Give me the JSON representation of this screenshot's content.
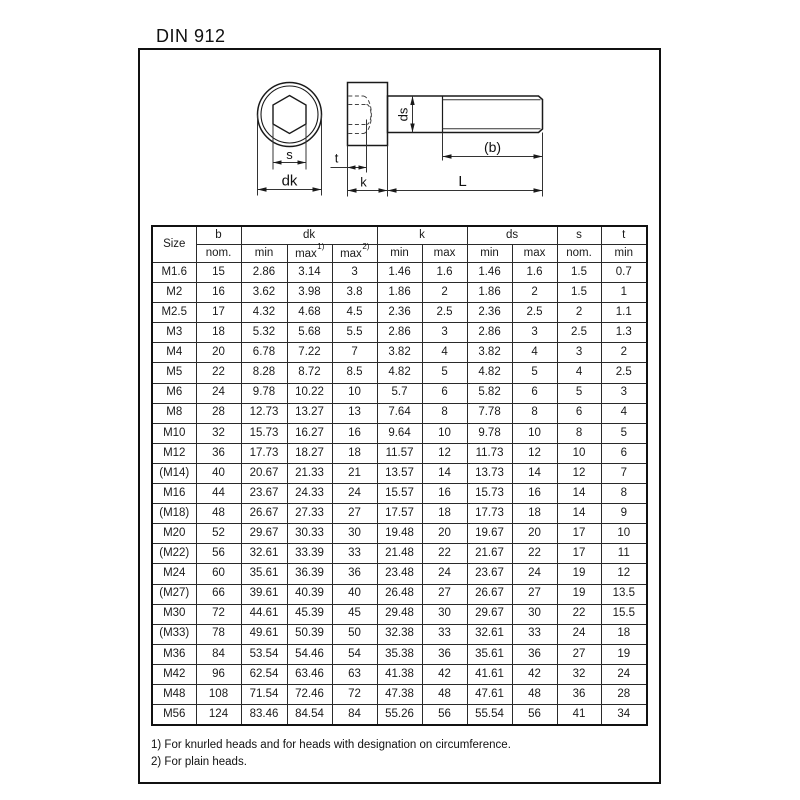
{
  "page": {
    "title": "DIN 912"
  },
  "drawing": {
    "labels": {
      "s": "s",
      "dk": "dk",
      "t": "t",
      "k": "k",
      "L": "L",
      "ds": "ds",
      "b": "(b)"
    }
  },
  "table": {
    "headers": {
      "size": "Size",
      "b": "b",
      "dk": "dk",
      "k": "k",
      "ds": "ds",
      "s": "s",
      "t": "t",
      "nom": "nom.",
      "min": "min",
      "max": "max",
      "sup1": "1)",
      "sup2": "2)"
    },
    "rows": [
      [
        "M1.6",
        "15",
        "2.86",
        "3.14",
        "3",
        "1.46",
        "1.6",
        "1.46",
        "1.6",
        "1.5",
        "0.7"
      ],
      [
        "M2",
        "16",
        "3.62",
        "3.98",
        "3.8",
        "1.86",
        "2",
        "1.86",
        "2",
        "1.5",
        "1"
      ],
      [
        "M2.5",
        "17",
        "4.32",
        "4.68",
        "4.5",
        "2.36",
        "2.5",
        "2.36",
        "2.5",
        "2",
        "1.1"
      ],
      [
        "M3",
        "18",
        "5.32",
        "5.68",
        "5.5",
        "2.86",
        "3",
        "2.86",
        "3",
        "2.5",
        "1.3"
      ],
      [
        "M4",
        "20",
        "6.78",
        "7.22",
        "7",
        "3.82",
        "4",
        "3.82",
        "4",
        "3",
        "2"
      ],
      [
        "M5",
        "22",
        "8.28",
        "8.72",
        "8.5",
        "4.82",
        "5",
        "4.82",
        "5",
        "4",
        "2.5"
      ],
      [
        "M6",
        "24",
        "9.78",
        "10.22",
        "10",
        "5.7",
        "6",
        "5.82",
        "6",
        "5",
        "3"
      ],
      [
        "M8",
        "28",
        "12.73",
        "13.27",
        "13",
        "7.64",
        "8",
        "7.78",
        "8",
        "6",
        "4"
      ],
      [
        "M10",
        "32",
        "15.73",
        "16.27",
        "16",
        "9.64",
        "10",
        "9.78",
        "10",
        "8",
        "5"
      ],
      [
        "M12",
        "36",
        "17.73",
        "18.27",
        "18",
        "11.57",
        "12",
        "11.73",
        "12",
        "10",
        "6"
      ],
      [
        "(M14)",
        "40",
        "20.67",
        "21.33",
        "21",
        "13.57",
        "14",
        "13.73",
        "14",
        "12",
        "7"
      ],
      [
        "M16",
        "44",
        "23.67",
        "24.33",
        "24",
        "15.57",
        "16",
        "15.73",
        "16",
        "14",
        "8"
      ],
      [
        "(M18)",
        "48",
        "26.67",
        "27.33",
        "27",
        "17.57",
        "18",
        "17.73",
        "18",
        "14",
        "9"
      ],
      [
        "M20",
        "52",
        "29.67",
        "30.33",
        "30",
        "19.48",
        "20",
        "19.67",
        "20",
        "17",
        "10"
      ],
      [
        "(M22)",
        "56",
        "32.61",
        "33.39",
        "33",
        "21.48",
        "22",
        "21.67",
        "22",
        "17",
        "11"
      ],
      [
        "M24",
        "60",
        "35.61",
        "36.39",
        "36",
        "23.48",
        "24",
        "23.67",
        "24",
        "19",
        "12"
      ],
      [
        "(M27)",
        "66",
        "39.61",
        "40.39",
        "40",
        "26.48",
        "27",
        "26.67",
        "27",
        "19",
        "13.5"
      ],
      [
        "M30",
        "72",
        "44.61",
        "45.39",
        "45",
        "29.48",
        "30",
        "29.67",
        "30",
        "22",
        "15.5"
      ],
      [
        "(M33)",
        "78",
        "49.61",
        "50.39",
        "50",
        "32.38",
        "33",
        "32.61",
        "33",
        "24",
        "18"
      ],
      [
        "M36",
        "84",
        "53.54",
        "54.46",
        "54",
        "35.38",
        "36",
        "35.61",
        "36",
        "27",
        "19"
      ],
      [
        "M42",
        "96",
        "62.54",
        "63.46",
        "63",
        "41.38",
        "42",
        "41.61",
        "42",
        "32",
        "24"
      ],
      [
        "M48",
        "108",
        "71.54",
        "72.46",
        "72",
        "47.38",
        "48",
        "47.61",
        "48",
        "36",
        "28"
      ],
      [
        "M56",
        "124",
        "83.46",
        "84.54",
        "84",
        "55.26",
        "56",
        "55.54",
        "56",
        "41",
        "34"
      ]
    ]
  },
  "footnotes": [
    "1) For knurled heads and for heads with designation on circumference.",
    "2) For plain heads."
  ]
}
